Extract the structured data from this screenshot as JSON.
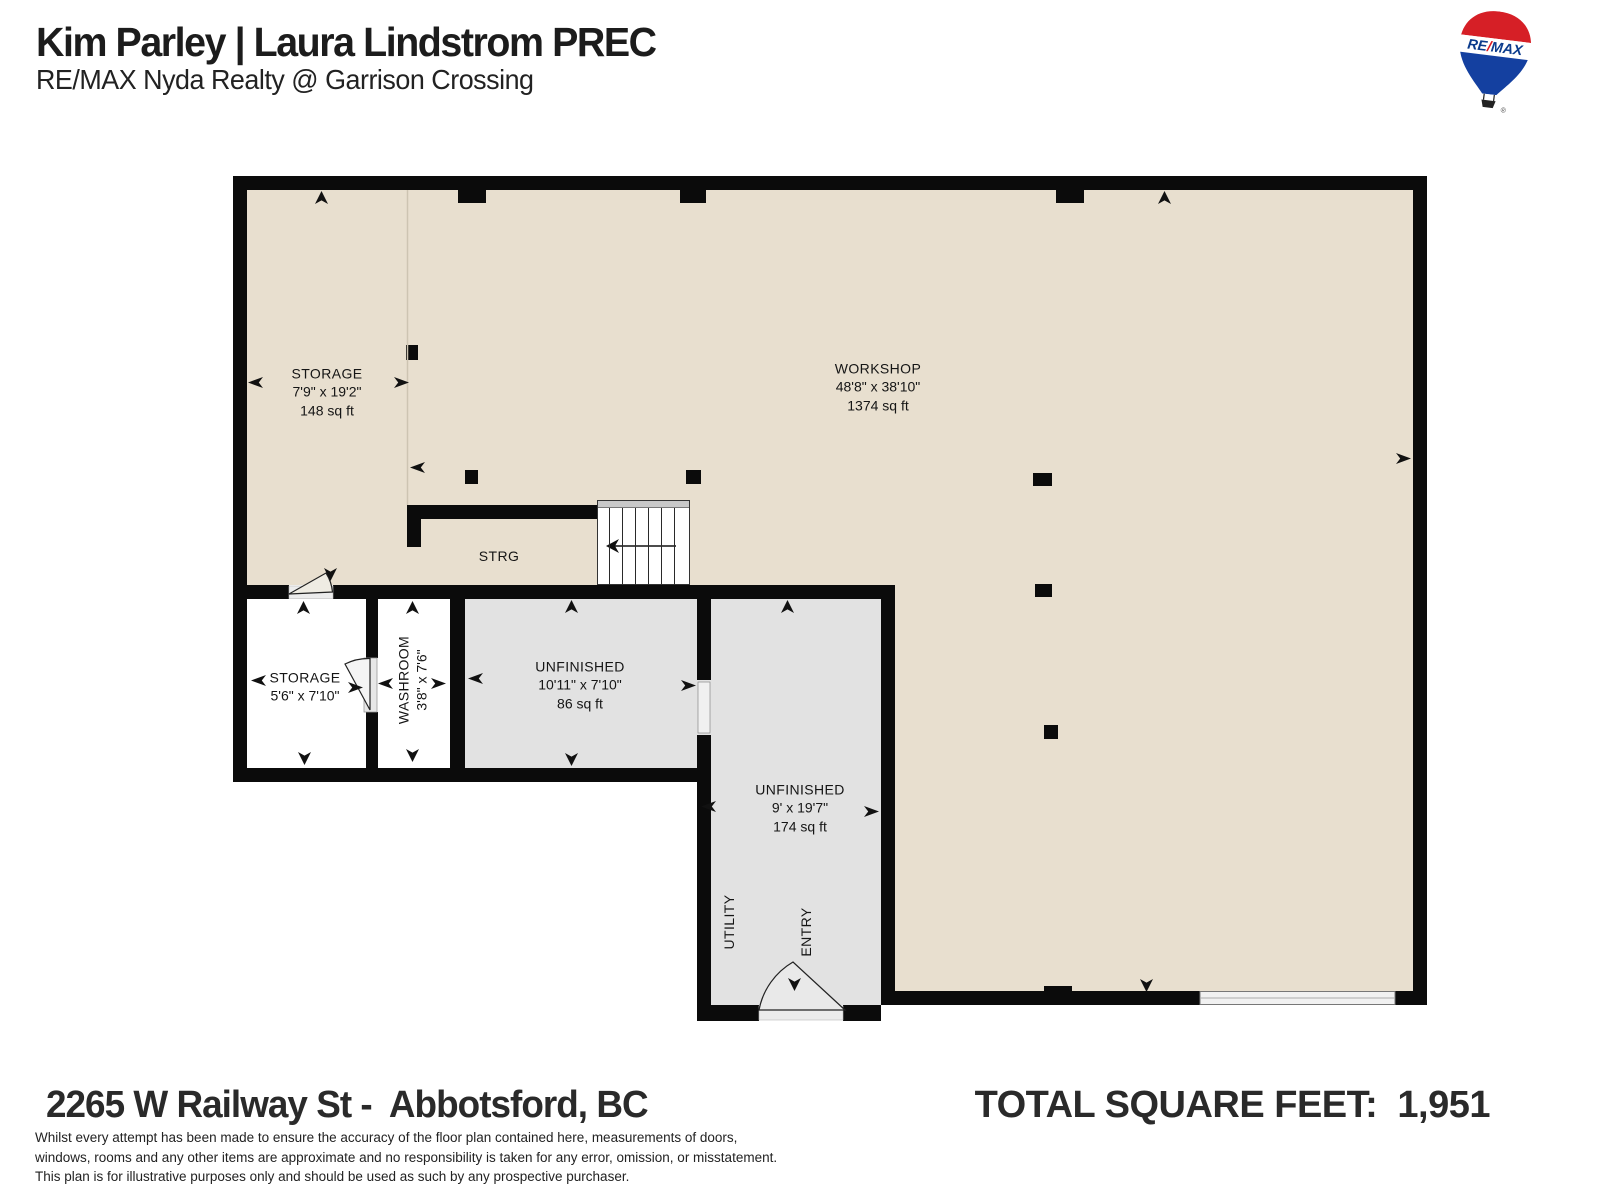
{
  "header": {
    "agent_names": "Kim Parley | Laura Lindstrom PREC",
    "brokerage": "RE/MAX Nyda Realty @ Garrison Crossing"
  },
  "logo": {
    "wordmark_left": "RE",
    "wordmark_slash": "/",
    "wordmark_right": "MAX",
    "registered_mark": "®",
    "balloon_red": "#d61f26",
    "balloon_blue": "#1440a0",
    "wordmark_blue": "#0b3b8c",
    "wordmark_red": "#e01b22"
  },
  "floorplan": {
    "palette": {
      "finished_floor": "#e8dfcf",
      "unfinished_floor": "#e2e2e2",
      "wall": "#0b0b0b"
    },
    "rooms": {
      "storage_upper": {
        "name": "STORAGE",
        "dims": "7'9\" x 19'2\"",
        "area": "148 sq ft"
      },
      "workshop": {
        "name": "WORKSHOP",
        "dims": "48'8\" x 38'10\"",
        "area": "1374 sq ft"
      },
      "strg": {
        "name": "STRG"
      },
      "storage_lower": {
        "name": "STORAGE",
        "dims": "5'6\" x 7'10\""
      },
      "washroom": {
        "name": "WASHROOM",
        "dims": "3'8\" x 7'6\""
      },
      "unfinished_small": {
        "name": "UNFINISHED",
        "dims": "10'11\" x 7'10\"",
        "area": "86 sq ft"
      },
      "unfinished_large": {
        "name": "UNFINISHED",
        "dims": "9' x 19'7\"",
        "area": "174 sq ft"
      },
      "utility": {
        "name": "UTILITY"
      },
      "entry": {
        "name": "ENTRY"
      }
    }
  },
  "footer": {
    "address": "2265 W Railway St -  Abbotsford, BC",
    "total_label": "TOTAL SQUARE FEET: ",
    "total_value": " 1,951",
    "disclaimer": [
      "Whilst every attempt has been made to ensure the accuracy of the floor plan contained here, measurements of doors,",
      "windows, rooms and any other items are approximate and no responsibility is taken for any error, omission, or misstatement.",
      "This plan is for illustrative purposes only and should be used as such by any prospective purchaser."
    ]
  }
}
